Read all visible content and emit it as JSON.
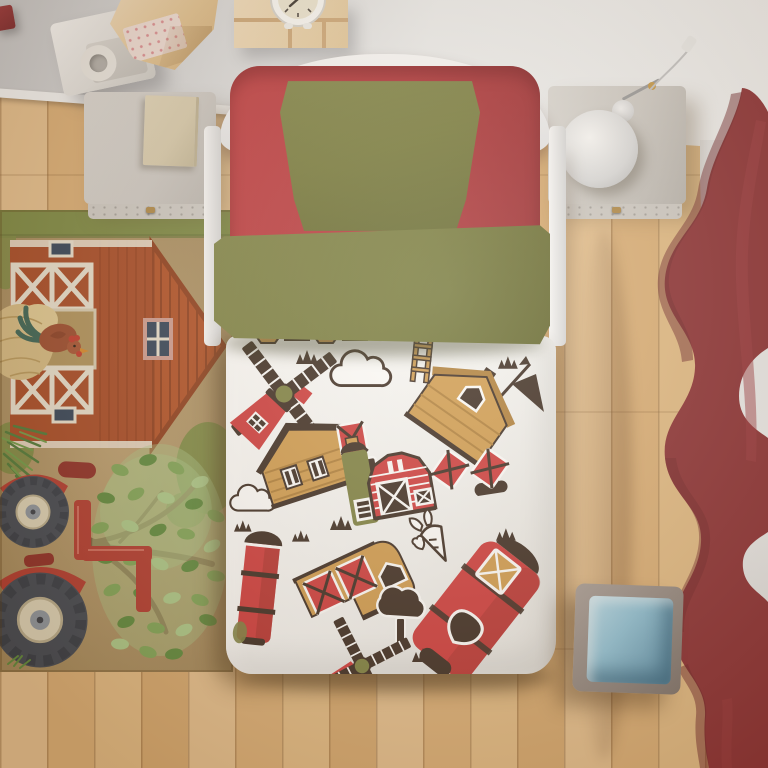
{
  "meta": {
    "type": "natural-image",
    "description": "Top-down 3D render of a child's bedroom: single bed with white farm-print duvet (barns, windmills, silos, clouds, grass), red fitted sheet, olive green pillow and folded blanket, farm-scene rug (red barn with rooster, watercolor tree, red tractor), light oak plank floor, dark red curtains on the right, two pale nightstands (one with a book, one with a white lamp), wall shelves with an alarm clock, and a grey cube stool with blue fabric lining."
  },
  "objects": [
    {
      "id": "bed",
      "label": "single bed with farm bedding"
    },
    {
      "id": "pillow",
      "label": "olive green pillow"
    },
    {
      "id": "blanket",
      "label": "olive green folded blanket"
    },
    {
      "id": "sheet",
      "label": "red fitted sheet"
    },
    {
      "id": "duvet",
      "label": "white duvet with farm pattern"
    },
    {
      "id": "rug",
      "label": "farm scene rug with barn, rooster, tree and tractor"
    },
    {
      "id": "curtain",
      "label": "dark red curtain"
    },
    {
      "id": "cube-stool",
      "label": "grey cube stool with blue lining"
    },
    {
      "id": "nightstand-left",
      "label": "left nightstand with book"
    },
    {
      "id": "nightstand-right",
      "label": "right nightstand with lamp"
    },
    {
      "id": "shelves",
      "label": "wall shelves with alarm clock"
    },
    {
      "id": "floor",
      "label": "light oak plank floor"
    }
  ],
  "colors": {
    "wall-a": "#c9cacd",
    "wall-b": "#eff0f1",
    "wall-side": "#e7e8ea",
    "baseboard": "#f5f6f7",
    "floor-a": "#e6c190",
    "floor-b": "#dcb078",
    "floor-c": "#e3bc86",
    "floor-d": "#d7aa71",
    "frame-white": "#f3f4f6",
    "sheet-red": "#b5343a",
    "sheet-red-dark": "#9c2b31",
    "sheet-red-light": "#c23d43",
    "olive": "#767a3c",
    "olive-light": "#82874a",
    "olive-dark": "#63672e",
    "duvet": "#fcfcfc",
    "pat-dark": "#3b2b22",
    "pat-red": "#cf3a3c",
    "pat-red-dark": "#a82e2c",
    "pat-tan": "#d19c4f",
    "pat-tan-dark": "#b07f3a",
    "pat-olive": "#7d8142",
    "rug-tan": "#b39767",
    "rug-tan-dark": "#9d8353",
    "rug-green": "#7c8a44",
    "rug-barn": "#a84a26",
    "rug-barn-dark": "#8f3d1c",
    "rug-gable": "#b25026",
    "trim": "#e9e2d2",
    "navy": "#32435a",
    "hay": "#d6bc85",
    "hay-light": "#e2cc96",
    "rooster": "#9c4b2f",
    "rooster-dark": "#8a3f26",
    "comb": "#c23b2e",
    "beak": "#d88a2e",
    "tailfeather": "#3a6456",
    "green-1": "#7fa558",
    "green-2": "#5d8a3e",
    "green-3": "#abc98a",
    "branch": "#7d5c3d",
    "tractor-red": "#b23a30",
    "tractor-dark": "#8e2d27",
    "wheel": "#414854",
    "wheel-tread": "#343b47",
    "hub": "#ddd4ba",
    "hub-center": "#8d96a1",
    "curtain": "#8c2f35",
    "curtain-dark": "#6e2329",
    "curtain-light": "#9d3a41",
    "cube-a": "#a79d98",
    "cube-b": "#7e746f",
    "cube-blue": "#8fc3da",
    "cube-blue-light": "#b7dcec",
    "cube-blue-dark": "#5d93b0",
    "stand-a": "#dcdad7",
    "stand-b": "#bbb7b3",
    "stand-front": "#cfccc8",
    "book": "#d9cdb0",
    "knob": "#b08948",
    "shelf-a": "#f3ddbc",
    "shelf-b": "#d2ad79",
    "clock-face": "#efe9d6",
    "gable-win": "#cf9d93",
    "paper": "#f1e0da"
  }
}
